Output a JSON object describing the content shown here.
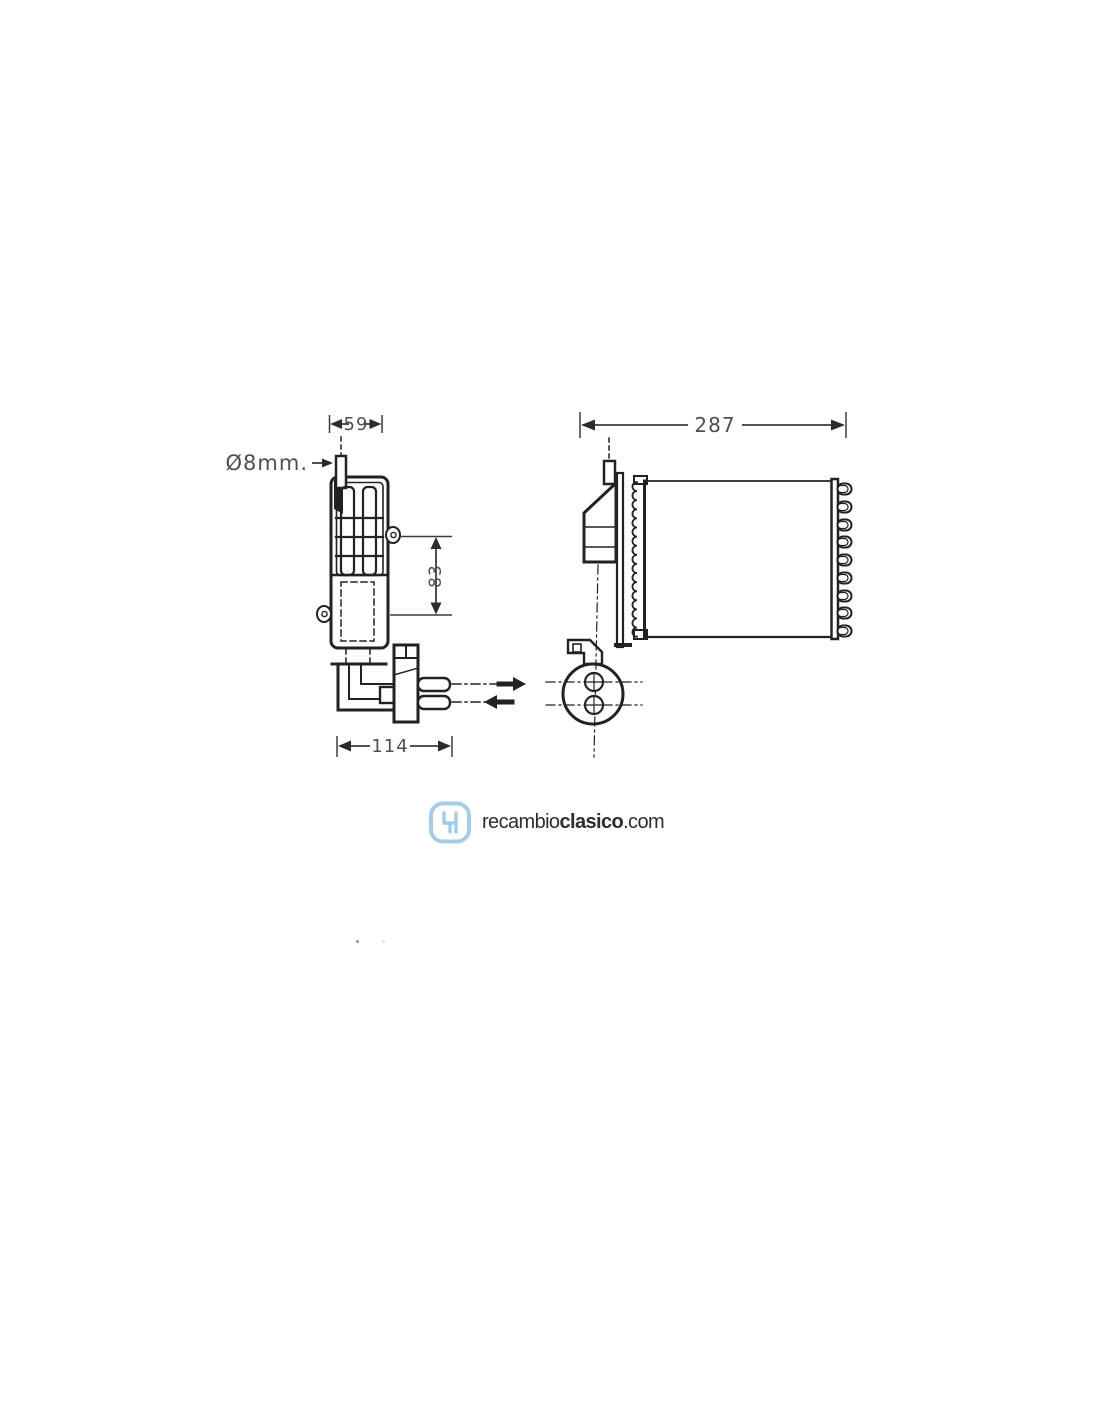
{
  "diagram": {
    "title": "heater-core-technical-drawing",
    "dimensions": {
      "pipe_diameter": "Ø8mm.",
      "top_width": "59",
      "side_height": "83",
      "bottom_width": "114",
      "front_width": "287"
    },
    "line_color": "#222222",
    "dimension_text_color": "#4f4f4f"
  },
  "watermark": {
    "brand_regular": "recambio",
    "brand_bold": "clasico",
    "domain_suffix": ".com",
    "icon": "gear-shift-pattern-icon",
    "icon_color": "#a6cbe7",
    "text_color": "#2d2d2d"
  }
}
